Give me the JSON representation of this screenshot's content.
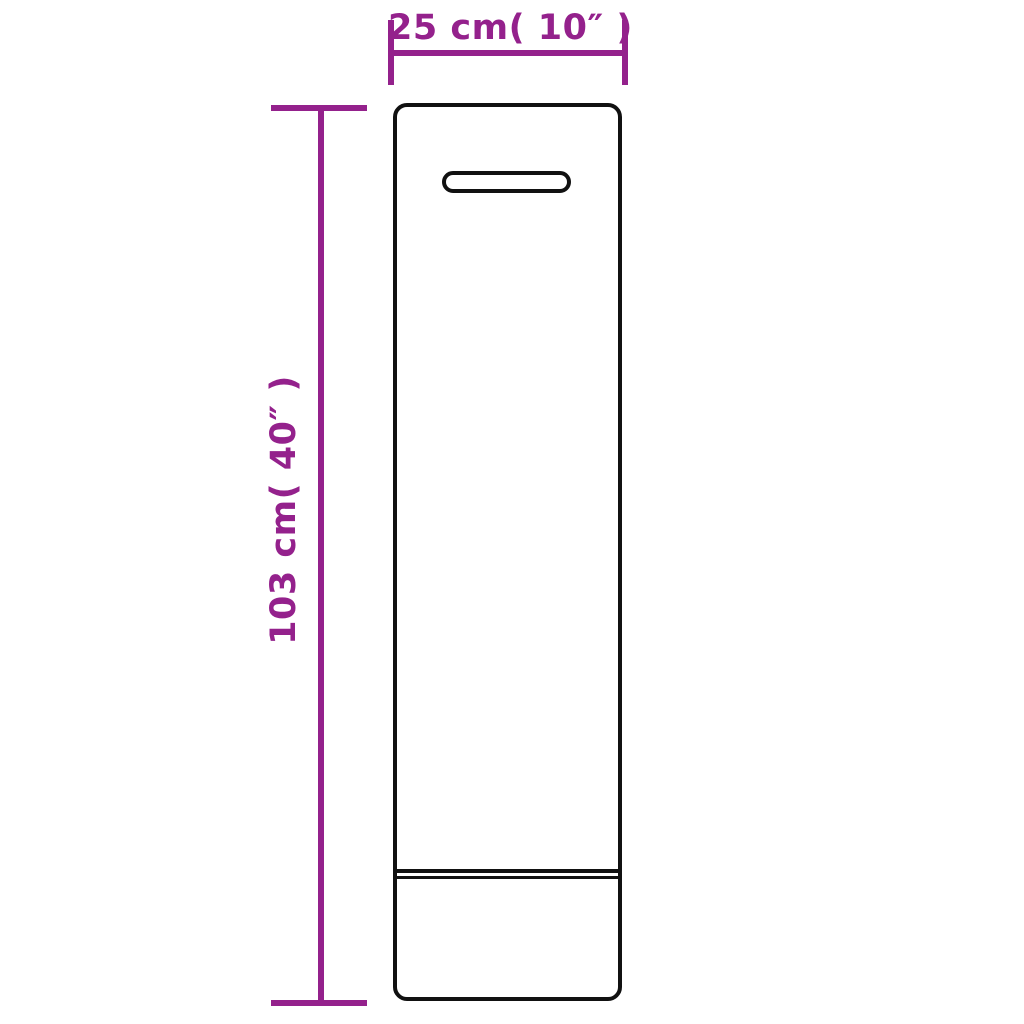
{
  "diagram": {
    "title": "product-dimension-diagram",
    "width_dimension": {
      "label": "25 cm( 10″ )",
      "value_cm": 25,
      "value_inch": 10
    },
    "height_dimension": {
      "label": "103 cm( 40″ )",
      "value_cm": 103,
      "value_inch": 40
    },
    "product": {
      "shape": "tall-rectangular-cover",
      "features": [
        "handle-slot",
        "bottom-seam-double-line"
      ]
    }
  },
  "colors": {
    "dimension": "#94218C",
    "outline": "#111111",
    "background": "#FFFFFF"
  }
}
